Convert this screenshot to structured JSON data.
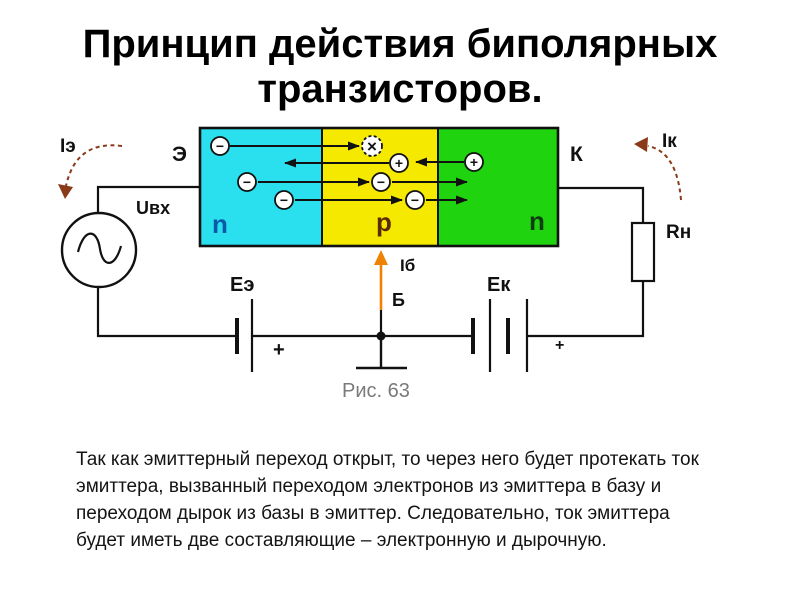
{
  "slide": {
    "title": "Принцип действия биполярных\nтранзисторов.",
    "body_text": "Так как эмиттерный переход открыт, то через него будет протекать ток\nэмиттера, вызванный переходом электронов из эмиттера в базу и\nпереходом дырок из базы в эмиттер. Следовательно, ток эмиттера\nбудет иметь две составляющие – электронную и дырочную."
  },
  "figure": {
    "caption": "Рис. 63",
    "labels": {
      "emitter_current": "Iэ",
      "emitter_terminal": "Э",
      "input_voltage": "Uвх",
      "emitter_region": "n",
      "base_region": "p",
      "collector_region": "n",
      "collector_terminal": "К",
      "collector_current": "Iк",
      "load_resistor": "Rн",
      "emitter_battery": "Eэ",
      "collector_battery": "Eк",
      "base_current": "Iб",
      "base_terminal": "Б",
      "emitter_battery_polarity": "+",
      "collector_battery_polarity": "+"
    },
    "symbols": {
      "electron": "−",
      "hole": "+",
      "recombination": "×"
    },
    "colors": {
      "emitter_region_fill": "#2ae0ee",
      "base_region_fill": "#f5e900",
      "collector_region_fill": "#1fd40f",
      "emitter_region_label": "#0a58a8",
      "base_region_label": "#5a2b00",
      "collector_region_label": "#0f3d12",
      "current_arrow": "#8a3a18",
      "base_current_arrow": "#ef8200",
      "caption_text": "#7a7a7a"
    }
  }
}
